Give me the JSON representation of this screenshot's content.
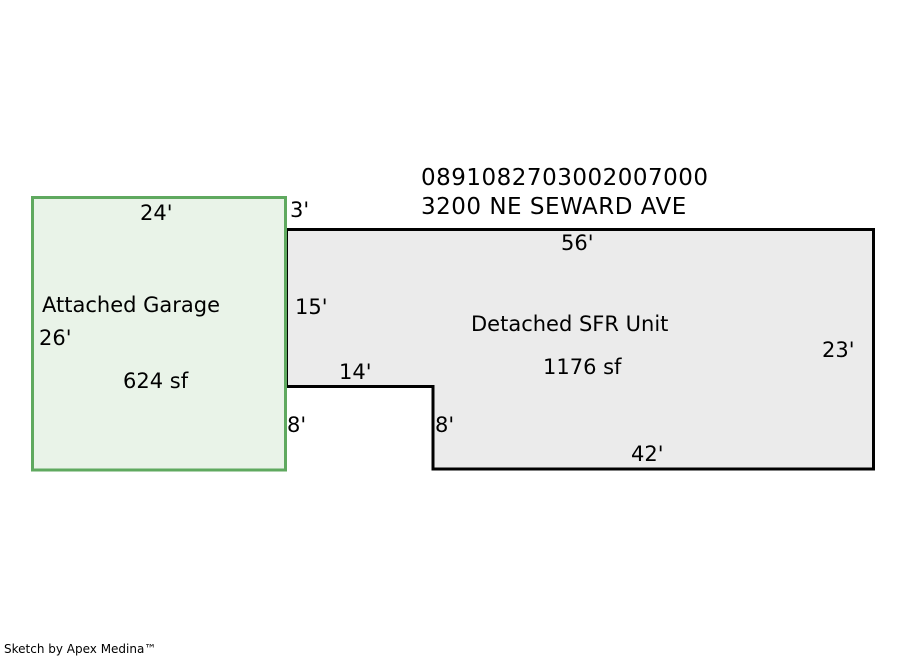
{
  "header": {
    "parcel_id": "0891082703002007000",
    "address": "3200 NE SEWARD AVE"
  },
  "garage": {
    "label": "Attached Garage",
    "area": "624 sf",
    "width_ft": "24'",
    "height_ft": "26'"
  },
  "sfr": {
    "label": "Detached SFR Unit",
    "area": "1176 sf",
    "top_ft": "56'",
    "right_ft": "23'",
    "bottom_ft": "42'",
    "left_upper_ft": "15'",
    "offset_top_ft": "3'",
    "notch_top_ft": "14'",
    "notch_left_ft": "8'",
    "notch_right_ft": "8'"
  },
  "footer": {
    "credit": "Sketch by Apex Medina™"
  },
  "colors": {
    "garage_fill": "#e9f3e8",
    "garage_stroke": "#5fa95f",
    "sfr_fill": "#ebebeb",
    "sfr_stroke": "#000000",
    "text": "#000000",
    "background": "#ffffff"
  }
}
